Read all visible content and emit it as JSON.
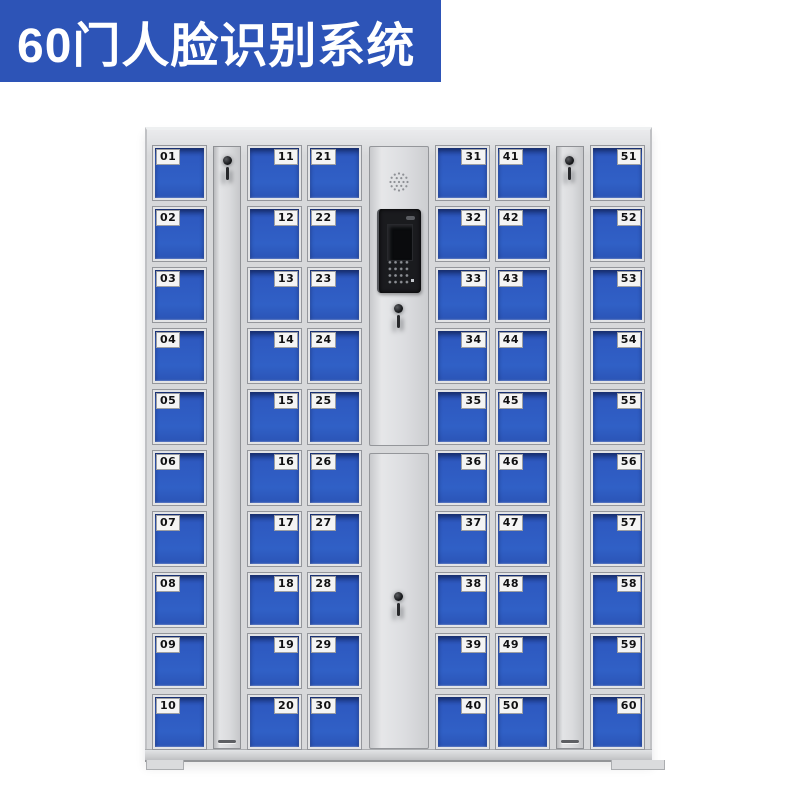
{
  "banner": {
    "title": "60门人脸识别系统"
  },
  "colors": {
    "banner_bg": "#2d54b7",
    "banner_text": "#ffffff",
    "door_blue": "#2e59c0",
    "cabinet_body": "#d7d8da",
    "panel_gray": "#dcdde0",
    "label_bg": "#f4f4f4",
    "label_text": "#101012",
    "screen_black": "#1a1b1e"
  },
  "locker": {
    "total_doors": 60,
    "columns": [
      {
        "name": "door-column-01-10",
        "number_position": "left",
        "doors": [
          "01",
          "02",
          "03",
          "04",
          "05",
          "06",
          "07",
          "08",
          "09",
          "10"
        ]
      },
      {
        "name": "lock-strip-left",
        "type": "strip"
      },
      {
        "name": "door-column-11-20",
        "number_position": "right",
        "doors": [
          "11",
          "12",
          "13",
          "14",
          "15",
          "16",
          "17",
          "18",
          "19",
          "20"
        ]
      },
      {
        "name": "door-column-21-30",
        "number_position": "left",
        "doors": [
          "21",
          "22",
          "23",
          "24",
          "25",
          "26",
          "27",
          "28",
          "29",
          "30"
        ]
      },
      {
        "name": "control-panel-column",
        "type": "control"
      },
      {
        "name": "door-column-31-40",
        "number_position": "right",
        "doors": [
          "31",
          "32",
          "33",
          "34",
          "35",
          "36",
          "37",
          "38",
          "39",
          "40"
        ]
      },
      {
        "name": "door-column-41-50",
        "number_position": "left",
        "doors": [
          "41",
          "42",
          "43",
          "44",
          "45",
          "46",
          "47",
          "48",
          "49",
          "50"
        ]
      },
      {
        "name": "lock-strip-right",
        "type": "strip"
      },
      {
        "name": "door-column-51-60",
        "number_position": "right",
        "doors": [
          "51",
          "52",
          "53",
          "54",
          "55",
          "56",
          "57",
          "58",
          "59",
          "60"
        ]
      }
    ],
    "icons": {
      "speaker": "speaker-grille-icon",
      "screen": "face-recognition-screen",
      "camera": "camera-icon",
      "keypad": "keypad-dots-icon",
      "keyhole": "keyhole-icon"
    }
  }
}
